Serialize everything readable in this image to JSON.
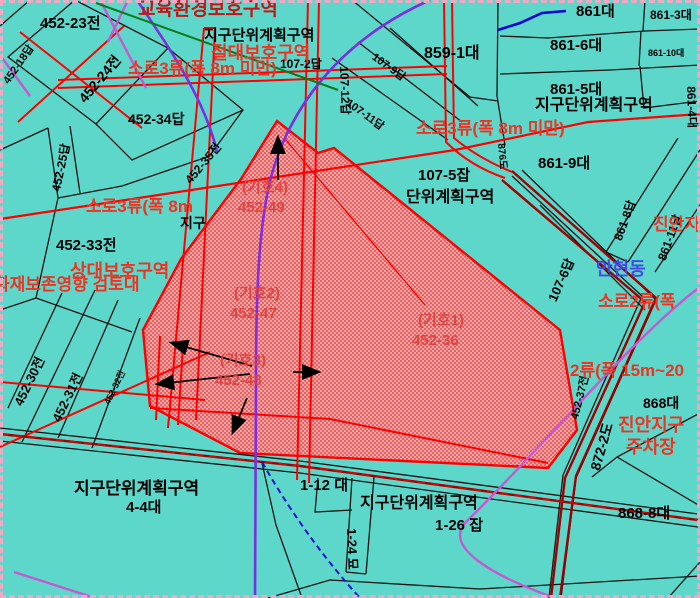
{
  "map": {
    "colors": {
      "background": "#5dd7ca",
      "parcel_line": "#111111",
      "road_red": "#ff0000",
      "road_dark_red": "#a00000",
      "zone_purple": "#7b2fe0",
      "zone_magenta": "#c45ad0",
      "zone_green": "#0a7a1a",
      "zone_blue": "#1515cc",
      "highlight_fill": "#f9a5a5",
      "highlight_dot": "#e03030",
      "label_red": "#ef3323",
      "label_blue": "#4848e8"
    },
    "labels": {
      "parcels": {
        "p452_23": "452-23전",
        "p452_18": "452-18답",
        "p452_24": "452-24전",
        "p452_34": "452-34답",
        "p452_25": "452-25답",
        "p452_35": "452-35전",
        "p452_33": "452-33전",
        "p452_30": "452-30전",
        "p452_31": "452-31전",
        "p452_32": "452-32전",
        "p107_2": "107-2답",
        "p107_12": "107-12답",
        "p107_9": "107-9답",
        "p107_11": "107-11답",
        "p859_1": "859-1대",
        "p861": "861대",
        "p861_3": "861-3대",
        "p861_6": "861-6대",
        "p861_10": "861-10대",
        "p861_5": "861-5대",
        "p861_4": "861-4대",
        "p861_9": "861-9대",
        "p861_8": "861-8답",
        "p861_11": "861-11답",
        "p107_5": "107-5잡",
        "p107_6": "107-6답",
        "p876": "876도",
        "p452_37": "452-37전",
        "p872_2": "872-2도",
        "p868": "868대",
        "p868_8": "868-8대",
        "p1_12": "1-12 대",
        "p1_26": "1-26 잡",
        "p1_24": "1-24 묘",
        "p4_4": "4-4대",
        "pjigu_frag": "지구"
      },
      "zones": {
        "z_top": "지구단위계획구역",
        "z_right": "지구단위계획구역",
        "z_mid": "단위계획구역",
        "z_bottom": "지구단위계획구역",
        "z_bottom_left": "지구단위계획구역"
      },
      "protection": {
        "education": "교육환경보호구역",
        "absolute": "절대보호구역",
        "relative": "상대보호구역",
        "heritage": "화재보존영향 검토대"
      },
      "roads": {
        "soro3_top": "소로3류(폭 8m 미만)",
        "soro3_mid": "소로3류(폭 8m 미만)",
        "soro3_left": "소로3류(폭 8m",
        "soro2_right": "소로2류(폭",
        "jungro2_right": "2류(폭 15m~20"
      },
      "districts": {
        "jinan_partial": "진안지",
        "jinan_jigu": "진안지구",
        "parking": "주차장",
        "anhyeondong": "안현동"
      },
      "symbols": {
        "s4_title": "(기호4)",
        "s4_lot": "452-49",
        "s2_title": "(기호2)",
        "s2_lot": "452-47",
        "s3_title": "(기호3)",
        "s3_lot": "452-48",
        "s1_title": "(기호1)",
        "s1_lot": "452-36"
      }
    }
  }
}
